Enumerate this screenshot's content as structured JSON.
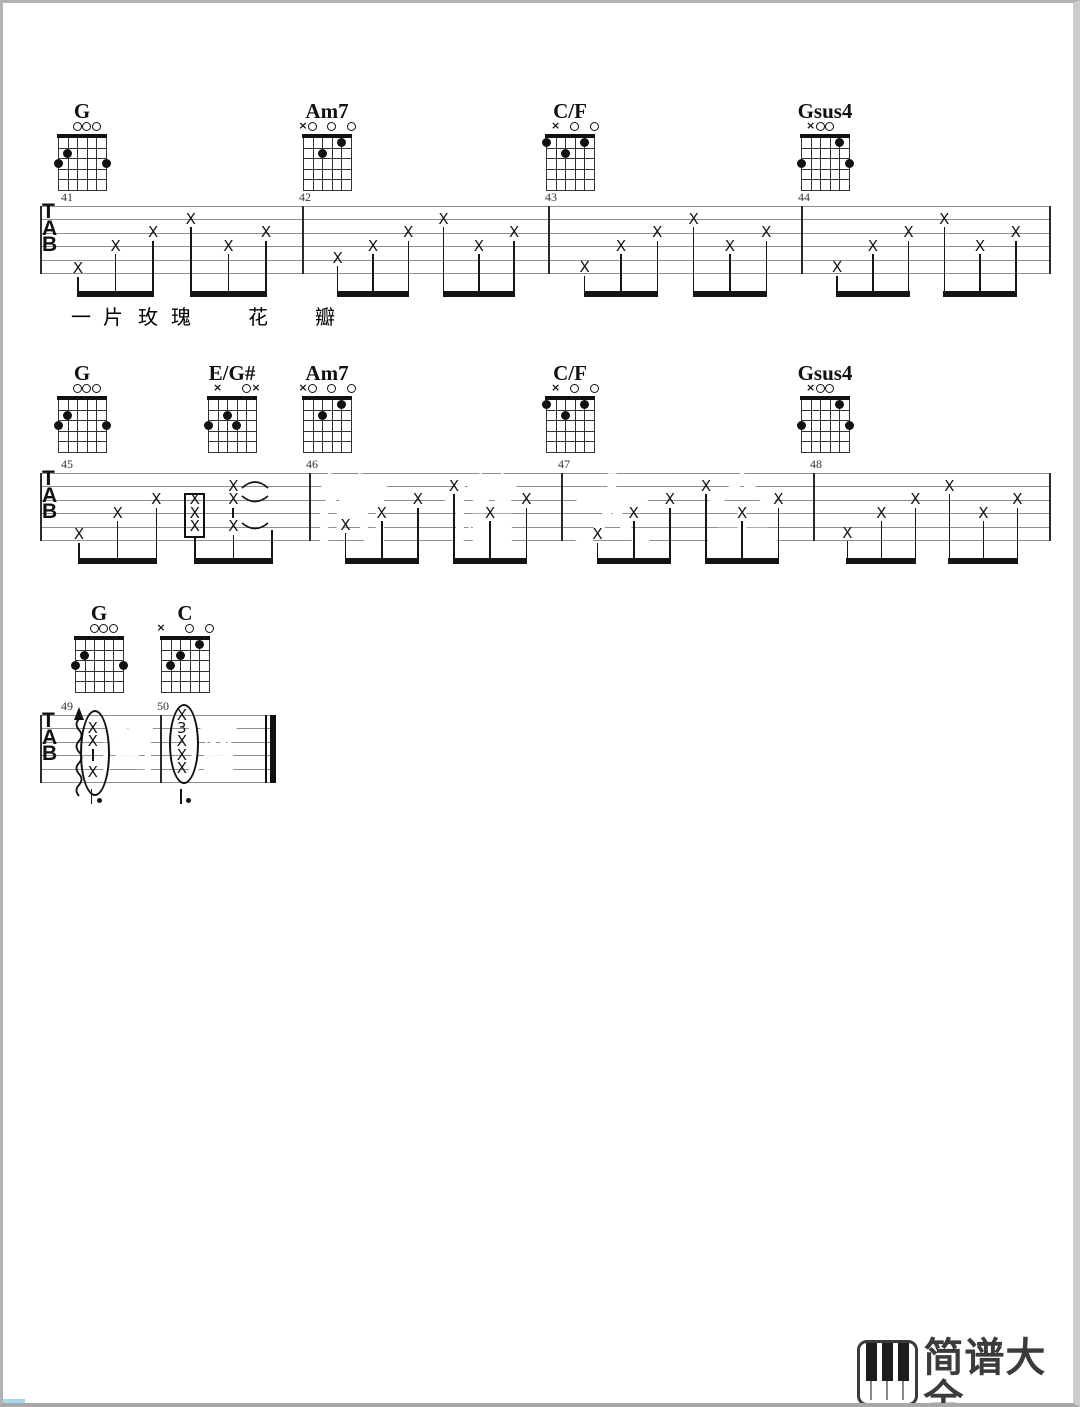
{
  "page": {
    "width": 1080,
    "height": 1407,
    "background": "#ffffff",
    "frame_color": "#b2b2b2"
  },
  "ink": "#151515",
  "staff_line_color": "#8f8f8f",
  "tab_clef": [
    "T",
    "A",
    "B"
  ],
  "chord_shapes": {
    "G": {
      "markers": [
        [
          "o",
          2
        ],
        [
          "o",
          3
        ],
        [
          "o",
          4
        ]
      ],
      "dots": [
        [
          2,
          1
        ],
        [
          3,
          0
        ],
        [
          3,
          5
        ]
      ]
    },
    "Am7": {
      "markers": [
        [
          "x",
          0
        ],
        [
          "o",
          1
        ],
        [
          "o",
          3
        ],
        [
          "o",
          5
        ]
      ],
      "dots": [
        [
          2,
          2
        ],
        [
          1,
          4
        ]
      ]
    },
    "C/F": {
      "markers": [
        [
          "x",
          1
        ],
        [
          "o",
          3
        ],
        [
          "o",
          5
        ]
      ],
      "dots": [
        [
          1,
          0
        ],
        [
          2,
          2
        ],
        [
          1,
          4
        ]
      ]
    },
    "Gsus4": {
      "markers": [
        [
          "x",
          1
        ],
        [
          "o",
          2
        ],
        [
          "o",
          3
        ]
      ],
      "dots": [
        [
          1,
          4
        ],
        [
          3,
          0
        ],
        [
          3,
          5
        ]
      ]
    },
    "E/G#": {
      "markers": [
        [
          "x",
          1
        ],
        [
          "o",
          4
        ],
        [
          "x",
          5
        ]
      ],
      "dots": [
        [
          2,
          2
        ],
        [
          3,
          0
        ],
        [
          3,
          3
        ]
      ]
    },
    "C": {
      "markers": [
        [
          "x",
          0
        ],
        [
          "o",
          3
        ],
        [
          "o",
          5
        ]
      ],
      "dots": [
        [
          1,
          4
        ],
        [
          2,
          2
        ],
        [
          3,
          1
        ]
      ]
    }
  },
  "rows": [
    {
      "staff_x": 37,
      "staff_y": 203,
      "staff_right": 1047,
      "end": "single",
      "diagram_y": 131,
      "chords": [
        {
          "name": "G",
          "x": 55
        },
        {
          "name": "Am7",
          "x": 300
        },
        {
          "name": "C/F",
          "x": 543
        },
        {
          "name": "Gsus4",
          "x": 798
        }
      ],
      "measures": [
        {
          "number": "41",
          "x": 37,
          "width": 262,
          "type": "strum",
          "strings": [
            5.7,
            4,
            3,
            2,
            4,
            3
          ]
        },
        {
          "number": "42",
          "x": 299,
          "width": 246,
          "type": "strum",
          "strings": [
            4.9,
            4,
            3,
            2,
            4,
            3
          ]
        },
        {
          "number": "43",
          "x": 545,
          "width": 253,
          "type": "strum",
          "strings": [
            5.6,
            4,
            3,
            2,
            4,
            3
          ]
        },
        {
          "number": "44",
          "x": 798,
          "width": 249,
          "type": "strum",
          "strings": [
            5.6,
            4,
            3,
            2,
            4,
            3
          ]
        }
      ],
      "lyrics": {
        "y": 298,
        "chars": [
          {
            "t": "一",
            "x": 78
          },
          {
            "t": "片",
            "x": 110
          },
          {
            "t": "玫",
            "x": 145
          },
          {
            "t": "瑰",
            "x": 178
          },
          {
            "t": "花",
            "x": 255
          },
          {
            "t": "瓣",
            "x": 322
          }
        ]
      }
    },
    {
      "staff_x": 37,
      "staff_y": 470,
      "staff_right": 1047,
      "end": "single",
      "diagram_y": 393,
      "chords": [
        {
          "name": "G",
          "x": 55
        },
        {
          "name": "E/G#",
          "x": 205
        },
        {
          "name": "Am7",
          "x": 300
        },
        {
          "name": "C/F",
          "x": 543
        },
        {
          "name": "Gsus4",
          "x": 798
        }
      ],
      "measures": [
        {
          "number": "45",
          "x": 37,
          "width": 269,
          "type": "mixed",
          "strings": [
            5.6,
            4,
            3
          ],
          "box_strings": [
            3,
            4,
            5
          ],
          "stack": [
            [
              "x",
              2
            ],
            [
              "x",
              3
            ],
            [
              "tick",
              4
            ],
            [
              "x",
              5
            ]
          ]
        },
        {
          "number": "46",
          "x": 306,
          "width": 252,
          "type": "strum",
          "strings": [
            4.9,
            4,
            3,
            2,
            4,
            3
          ]
        },
        {
          "number": "47",
          "x": 558,
          "width": 252,
          "type": "strum",
          "strings": [
            5.6,
            4,
            3,
            2,
            4,
            3
          ]
        },
        {
          "number": "48",
          "x": 810,
          "width": 237,
          "type": "strum",
          "strings": [
            5.5,
            4,
            3,
            2,
            4,
            3
          ]
        }
      ]
    },
    {
      "staff_x": 37,
      "staff_y": 712,
      "staff_right": 273,
      "end": "final",
      "diagram_y": 633,
      "chords": [
        {
          "name": "G",
          "x": 72
        },
        {
          "name": "C",
          "x": 158
        }
      ],
      "measures": [
        {
          "number": "49",
          "x": 37,
          "width": 120,
          "type": "ellipse",
          "squiggle": 0.325,
          "ecx": 0.44,
          "ery": 41,
          "items": [
            [
              "x",
              2
            ],
            [
              "x",
              3
            ],
            [
              "tick",
              4
            ],
            [
              "x",
              5.3
            ]
          ],
          "stem_dot": 0.43
        },
        {
          "number": "50",
          "x": 157,
          "width": 105,
          "type": "ellipse",
          "ecx": 0.208,
          "ery": 38,
          "items": [
            [
              "x",
              1
            ],
            [
              "3",
              2
            ],
            [
              "x",
              3
            ],
            [
              "x",
              4
            ],
            [
              "x",
              5
            ]
          ],
          "stem_dot": 0.2
        }
      ]
    }
  ],
  "watermarks": [
    {
      "text": "简谱大全",
      "x": 310,
      "y": 448,
      "size": 78,
      "spacing": 52
    },
    {
      "text": "简谱",
      "x": 95,
      "y": 700,
      "size": 58,
      "spacing": 26
    }
  ],
  "logo": {
    "title": "简谱大全",
    "domain": "jianpudq.com",
    "color": "#3b3b3b"
  },
  "artifact_color": "#a9d6e8"
}
